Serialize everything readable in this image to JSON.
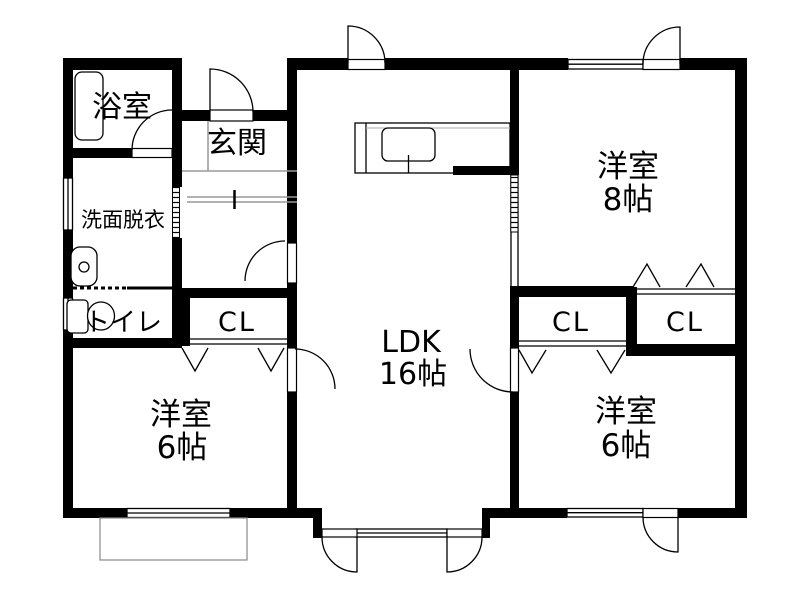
{
  "plan_title": "floor-plan",
  "colors": {
    "wall": "#000000",
    "background": "#ffffff",
    "thin_line": "#999999"
  },
  "rooms": [
    {
      "id": "bathroom",
      "label": "浴室"
    },
    {
      "id": "entrance",
      "label": "玄関"
    },
    {
      "id": "washroom",
      "label": "洗面脱衣"
    },
    {
      "id": "toilet",
      "label": "トイレ"
    },
    {
      "id": "closet-hall",
      "label": "CL"
    },
    {
      "id": "ldk",
      "label": "LDK",
      "size": "16帖"
    },
    {
      "id": "bedroom-southwest",
      "label": "洋室",
      "size": "6帖"
    },
    {
      "id": "bedroom-northeast",
      "label": "洋室",
      "size": "8帖"
    },
    {
      "id": "closet-east-left",
      "label": "CL"
    },
    {
      "id": "closet-east-right",
      "label": "CL"
    },
    {
      "id": "bedroom-southeast",
      "label": "洋室",
      "size": "6帖"
    }
  ],
  "fixtures": [
    "bathtub",
    "washbasin",
    "toilet-bowl",
    "kitchen-counter",
    "kitchen-sink",
    "terrace"
  ]
}
